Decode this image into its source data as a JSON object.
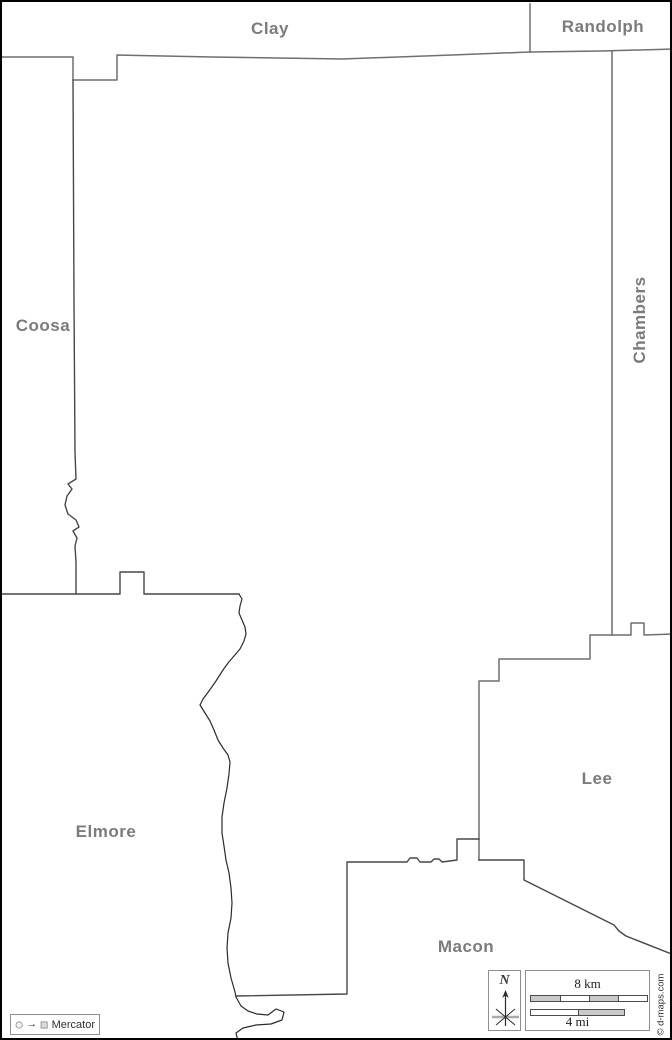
{
  "map": {
    "labels": {
      "clay": "Clay",
      "randolph": "Randolph",
      "coosa": "Coosa",
      "chambers": "Chambers",
      "elmore": "Elmore",
      "lee": "Lee",
      "macon": "Macon"
    },
    "colors": {
      "frame": "#000000",
      "boundary": "#6f6f6f",
      "boundary_dark": "#474747",
      "river": "#2b2b2b",
      "label": "#7b7b7b",
      "scale_fill": "#c9c9c9"
    },
    "paths": {
      "north": "M 0 55 L 71 55 M 71 55 L 71 78 L 115 78 L 115 53 L 210 55 L 340 57 L 450 53 L 528 50 L 600 49 L 672 47",
      "randolph_divider": "M 528 2 L 528 50",
      "east": "M 610 50 L 610 633",
      "chambers_lee_east": "M 610 633 L 629 633 L 629 621 L 642 621 L 642 633 L 672 632",
      "lee_west": "M 610 633 L 588 633 L 588 657 L 497 657 L 497 679 L 477 679 L 477 858",
      "macon_lee": "M 477 858 L 522 858 L 522 878 L 612 923 L 617 929 L 624 934 L 672 953",
      "west": "M 71 78 L 72 300 L 73 450 L 74 477 L 66 482 L 70 487 L 65 494 L 63 503 L 66 512 L 74 518 L 77 525 L 71 529 L 75 536 L 73 544 L 74 560 L 74 592",
      "coosa_south": "M 0 592 L 74 592 L 118 592 L 118 570 L 142 570 L 142 592 L 237 592",
      "river": "M 237 592 L 240 597 L 238 604 L 237 611 L 240 618 L 243 625 L 244 632 L 242 639 L 238 647 L 232 654 L 226 661 L 221 668 L 214 679 L 207 689 L 201 697 L 198 703 L 203 711 L 208 719 L 212 728 L 216 738 L 221 746 L 226 753 L 228 760 L 227 772 L 225 786 L 222 801 L 220 815 L 220 831 L 222 844 L 224 858 L 227 871 L 229 886 L 230 901 L 229 916 L 226 931 L 225 946 L 226 961 L 229 976 L 233 990 L 234 995",
      "river_south": "M 234 995 L 239 1004 L 246 1009 L 255 1012 L 266 1013 L 274 1007 L 282 1010 L 280 1018 L 269 1022 L 254 1023 L 241 1026 L 234 1031 L 236 1039",
      "macon_north": "M 234 994 L 345 992 L 345 860 L 405 860 L 408 856 L 415 856 L 418 860 L 429 860 L 432 857 L 437 857 L 440 860 L 455 858 L 455 837 L 477 837"
    }
  },
  "legend": {
    "projection_label": "Mercator",
    "arrow_glyph": "→"
  },
  "compass": {
    "north_label": "N"
  },
  "scale": {
    "km": "8 km",
    "mi": "4 mi"
  },
  "credit": "© d-maps.com"
}
